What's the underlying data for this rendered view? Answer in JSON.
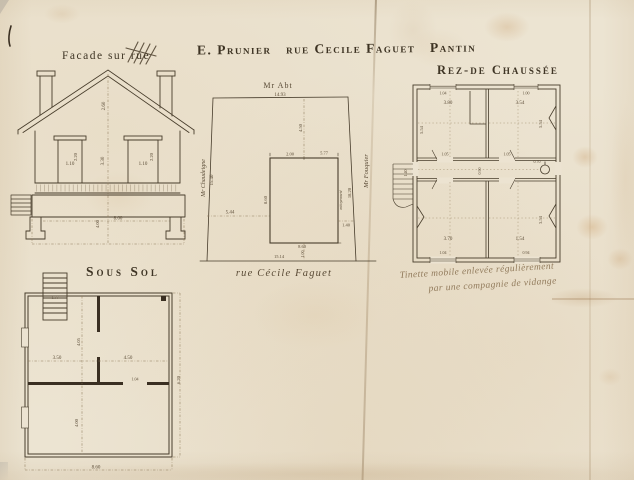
{
  "sheet": {
    "title": "E. Prunier   rue Cecile Faguet   Pantin"
  },
  "facade": {
    "label": "Facade sur rue",
    "dims": {
      "roof_height": "2.60",
      "story_height": "3.30",
      "window_left_width": "1.10",
      "window_left_height": "2.20",
      "window_right_width": "1.10",
      "window_right_height": "2.20",
      "base_width": "8.60",
      "base_height": "4.00"
    }
  },
  "site_plan": {
    "neighbor_top": "Mr Abt",
    "neighbor_top_dim": "14.93",
    "neighbor_left": "Mr Chaudeigne",
    "neighbor_left_dim": "15.40",
    "neighbor_right": "Mr Fouquier",
    "party_wall_label": "mitoyenneté",
    "party_wall_dim": "18.20",
    "street_label": "rue Cécile Faguet",
    "street_dim": "15.14",
    "court_depth": "4.50",
    "front_setback": "5.44",
    "side_gap": "1.40",
    "house_top_left": "2.00",
    "house_top_right": "5.77",
    "house_left": "8.60",
    "house_bottom": "8.60",
    "house_front": "1.00"
  },
  "ground_floor": {
    "label": "Rez-de Chaussée",
    "dims": {
      "room_tl_w": "3.80",
      "room_tr_w": "3.54",
      "room_tl_h": "5.54",
      "room_tr_h": "5.54",
      "room_bl_w": "3.70",
      "room_br_w": "1.54",
      "room_br_h": "3.54",
      "door_left": "1.05",
      "door_right": "1.05",
      "hall_w": "0.90",
      "stair_w": "1.40",
      "win_top_l": "1.04",
      "win_top_r": "1.00",
      "win_bot_l": "1.04",
      "win_bot_r": "0.94",
      "wc": "0.70"
    },
    "note_line1": "Tinette mobile enlevée régulièrement",
    "note_line2": "par une compagnie de vidange"
  },
  "basement": {
    "label": "Sous Sol",
    "dims": {
      "room_left_w": "3.50",
      "room_right_w": "4.50",
      "depth_front": "4.05",
      "depth_back": "4.00",
      "total_width": "8.60",
      "total_depth": "6.20",
      "stairs_w": "1.77",
      "door_w": "1.04"
    }
  }
}
